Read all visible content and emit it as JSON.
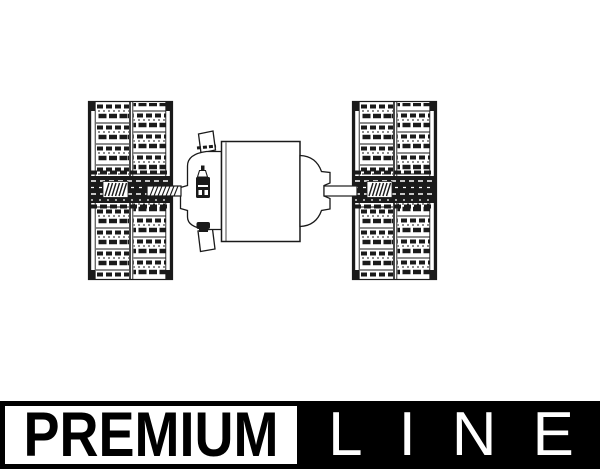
{
  "banner": {
    "premium": "PREMIUM",
    "line": "LINE",
    "premium_box": {
      "background": "#ffffff",
      "border": "#000000",
      "text": "#000000"
    },
    "line_box": {
      "background": "#000000",
      "text": "#ffffff"
    }
  },
  "drawing": {
    "ink_color": "#1a1a1a",
    "paper_color": "#ffffff"
  }
}
